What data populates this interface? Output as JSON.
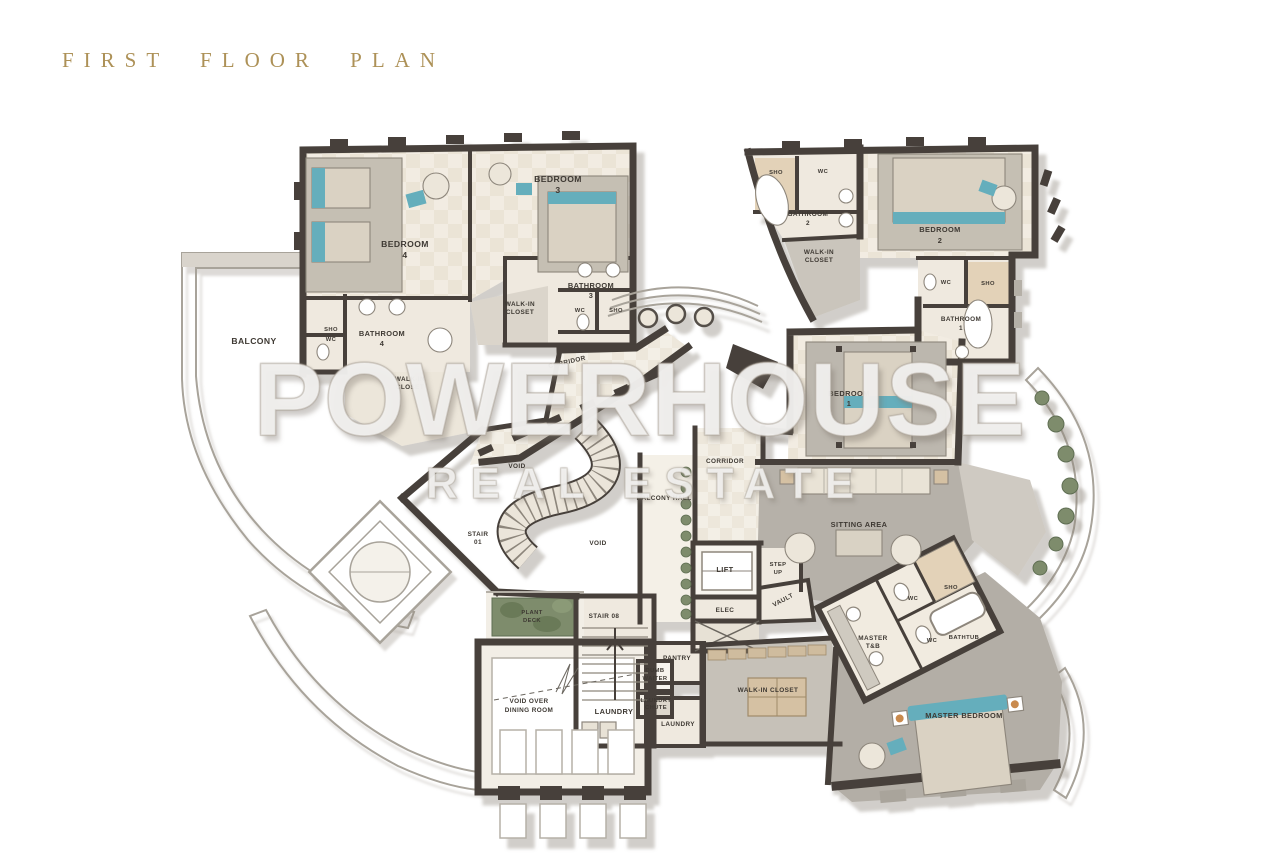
{
  "page": {
    "title": "FIRST FLOOR PLAN"
  },
  "watermark": {
    "line1": "POWERHOUSE",
    "line2": "REAL ESTATE"
  },
  "palette": {
    "wall": "#46413a",
    "floor": "#f1ece2",
    "floor_alt": "#ece5d8",
    "carpet_light": "#c5bfb3",
    "carpet_dark": "#b3aea6",
    "teal_accent": "#65aebc",
    "wood": "#d5c1a3",
    "tile_tan": "#e3d2b8",
    "plant_green": "#7e8c6c",
    "title_gold": "#ad9157",
    "outline_gray": "#a8a39a"
  },
  "rooms": {
    "bedroom4": {
      "lines": [
        "BEDROOM",
        "4"
      ]
    },
    "bedroom3": {
      "lines": [
        "BEDROOM",
        "3"
      ]
    },
    "bedroom2": {
      "lines": [
        "BEDROOM",
        "2"
      ]
    },
    "bedroom1": {
      "lines": [
        "BEDROOM",
        "1"
      ]
    },
    "bathroom4": {
      "lines": [
        "BATHROOM",
        "4"
      ]
    },
    "bathroom3": {
      "lines": [
        "BATHROOM",
        "3"
      ]
    },
    "bathroom2": {
      "lines": [
        "BATHROOM",
        "2"
      ]
    },
    "bathroom1": {
      "lines": [
        "BATHROOM",
        "1"
      ]
    },
    "walkin_b4": {
      "lines": [
        "WALK-IN",
        "CLOSET"
      ]
    },
    "walkin_b3": {
      "lines": [
        "WALK-IN",
        "CLOSET"
      ]
    },
    "walkin_b2": {
      "lines": [
        "WALK-IN",
        "CLOSET"
      ]
    },
    "walkin_master": {
      "lines": [
        "WALK-IN CLOSET"
      ]
    },
    "master_bedroom": {
      "lines": [
        "MASTER BEDROOM"
      ]
    },
    "master_tb": {
      "lines": [
        "MASTER",
        "T&B"
      ]
    },
    "sitting": {
      "lines": [
        "SITTING AREA"
      ]
    },
    "balcony": {
      "lines": [
        "BALCONY"
      ]
    },
    "balcony_hall": {
      "lines": [
        "BALCONY HALL"
      ]
    },
    "corridor_top": {
      "lines": [
        "CORRIDOR"
      ]
    },
    "corridor_right": {
      "lines": [
        "CORRIDOR"
      ]
    },
    "void_upper": {
      "lines": [
        "VOID"
      ]
    },
    "void_lower": {
      "lines": [
        "VOID"
      ]
    },
    "void_dining": {
      "lines": [
        "VOID OVER",
        "DINING ROOM"
      ]
    },
    "stair01": {
      "lines": [
        "STAIR",
        "01"
      ]
    },
    "stair08": {
      "lines": [
        "STAIR 08"
      ]
    },
    "lift": {
      "lines": [
        "LIFT"
      ]
    },
    "step_up": {
      "lines": [
        "STEP",
        "UP"
      ]
    },
    "elec": {
      "lines": [
        "ELEC"
      ]
    },
    "vault": {
      "lines": [
        "VAULT"
      ]
    },
    "pantry": {
      "lines": [
        "PANTRY"
      ]
    },
    "dumb_waiter": {
      "lines": [
        "DUMB",
        "WAITER"
      ]
    },
    "laundry_chute": {
      "lines": [
        "LAUNDRY",
        "CHUTE"
      ]
    },
    "laundry_1": {
      "lines": [
        "LAUNDRY"
      ]
    },
    "laundry_2": {
      "lines": [
        "LAUNDRY"
      ]
    },
    "plant_deck": {
      "lines": [
        "PLANT",
        "DECK"
      ]
    },
    "bathtub": {
      "lines": [
        "BATHTUB"
      ]
    },
    "sho_b4": {
      "lines": [
        "SHO"
      ]
    },
    "wc_b4": {
      "lines": [
        "WC"
      ]
    },
    "wc_b3": {
      "lines": [
        "WC"
      ]
    },
    "sho_b3": {
      "lines": [
        "SHO"
      ]
    },
    "sho_b2": {
      "lines": [
        "SHO"
      ]
    },
    "wc_b2": {
      "lines": [
        "WC"
      ]
    },
    "wc_b1": {
      "lines": [
        "WC"
      ]
    },
    "sho_b1": {
      "lines": [
        "SHO"
      ]
    },
    "wc_m1": {
      "lines": [
        "WC"
      ]
    },
    "wc_m2": {
      "lines": [
        "WC"
      ]
    },
    "sho_m": {
      "lines": [
        "SHO"
      ]
    }
  }
}
